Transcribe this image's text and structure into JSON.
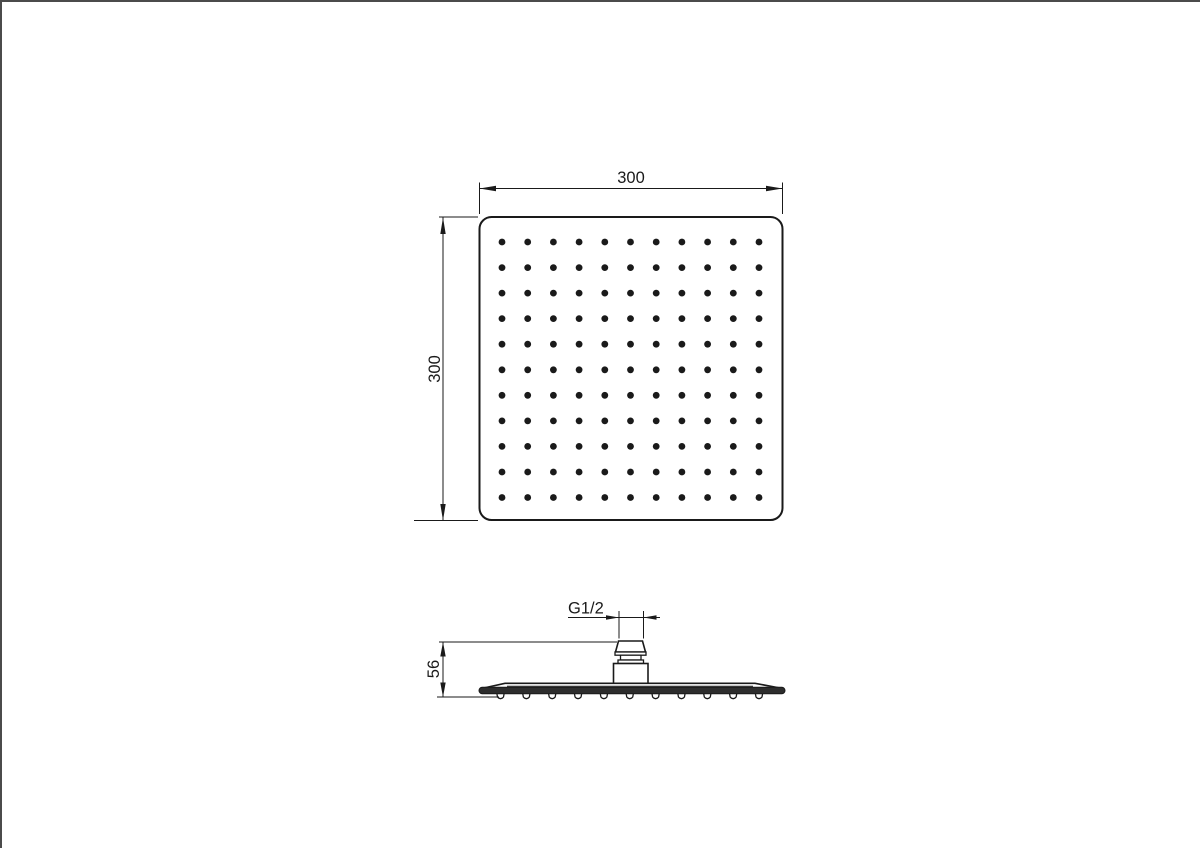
{
  "drawing": {
    "title": "square shower head technical drawing",
    "top_view": {
      "width_label": "300",
      "height_label": "300",
      "nozzle_grid": {
        "rows": 11,
        "cols": 11
      }
    },
    "side_view": {
      "thread_label": "G1/2",
      "height_label": "56",
      "nozzle_count": 11
    },
    "colors": {
      "line": "#1a1a1a",
      "rim_fill": "#2d2d2d",
      "background": "#ffffff"
    }
  }
}
